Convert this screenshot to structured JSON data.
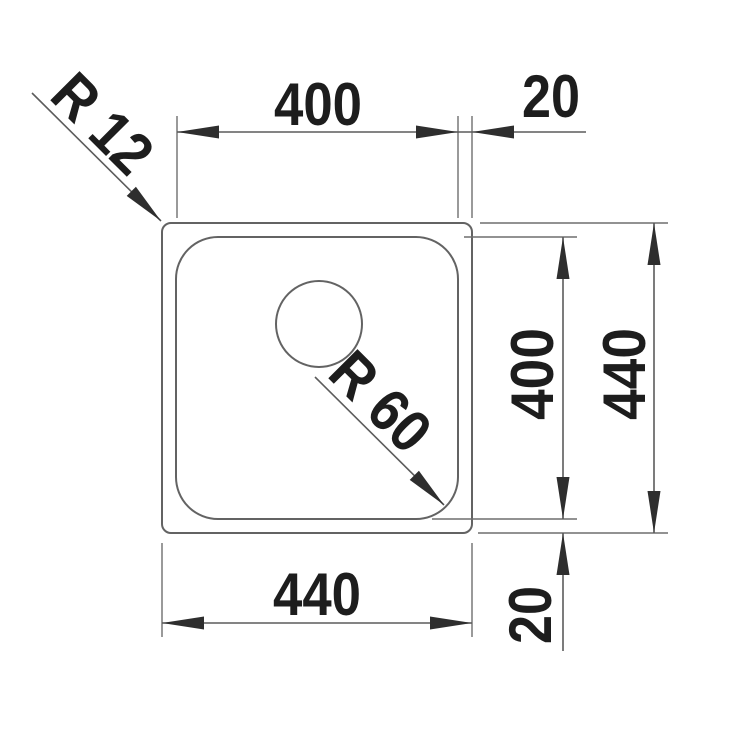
{
  "drawing": {
    "kind": "technical-dimension-drawing",
    "labels": {
      "top_width": "400",
      "top_right_offset": "20",
      "inner_height": "400",
      "outer_height": "440",
      "bottom_width": "440",
      "bottom_right_offset": "20",
      "outer_corner_radius": "R 12",
      "bowl_corner_radius": "R 60"
    },
    "colors": {
      "background": "#ffffff",
      "outline": "#636363",
      "dimension_line": "#5c5c5c",
      "arrow": "#2e2e2e",
      "text": "#1d1d1d"
    }
  }
}
